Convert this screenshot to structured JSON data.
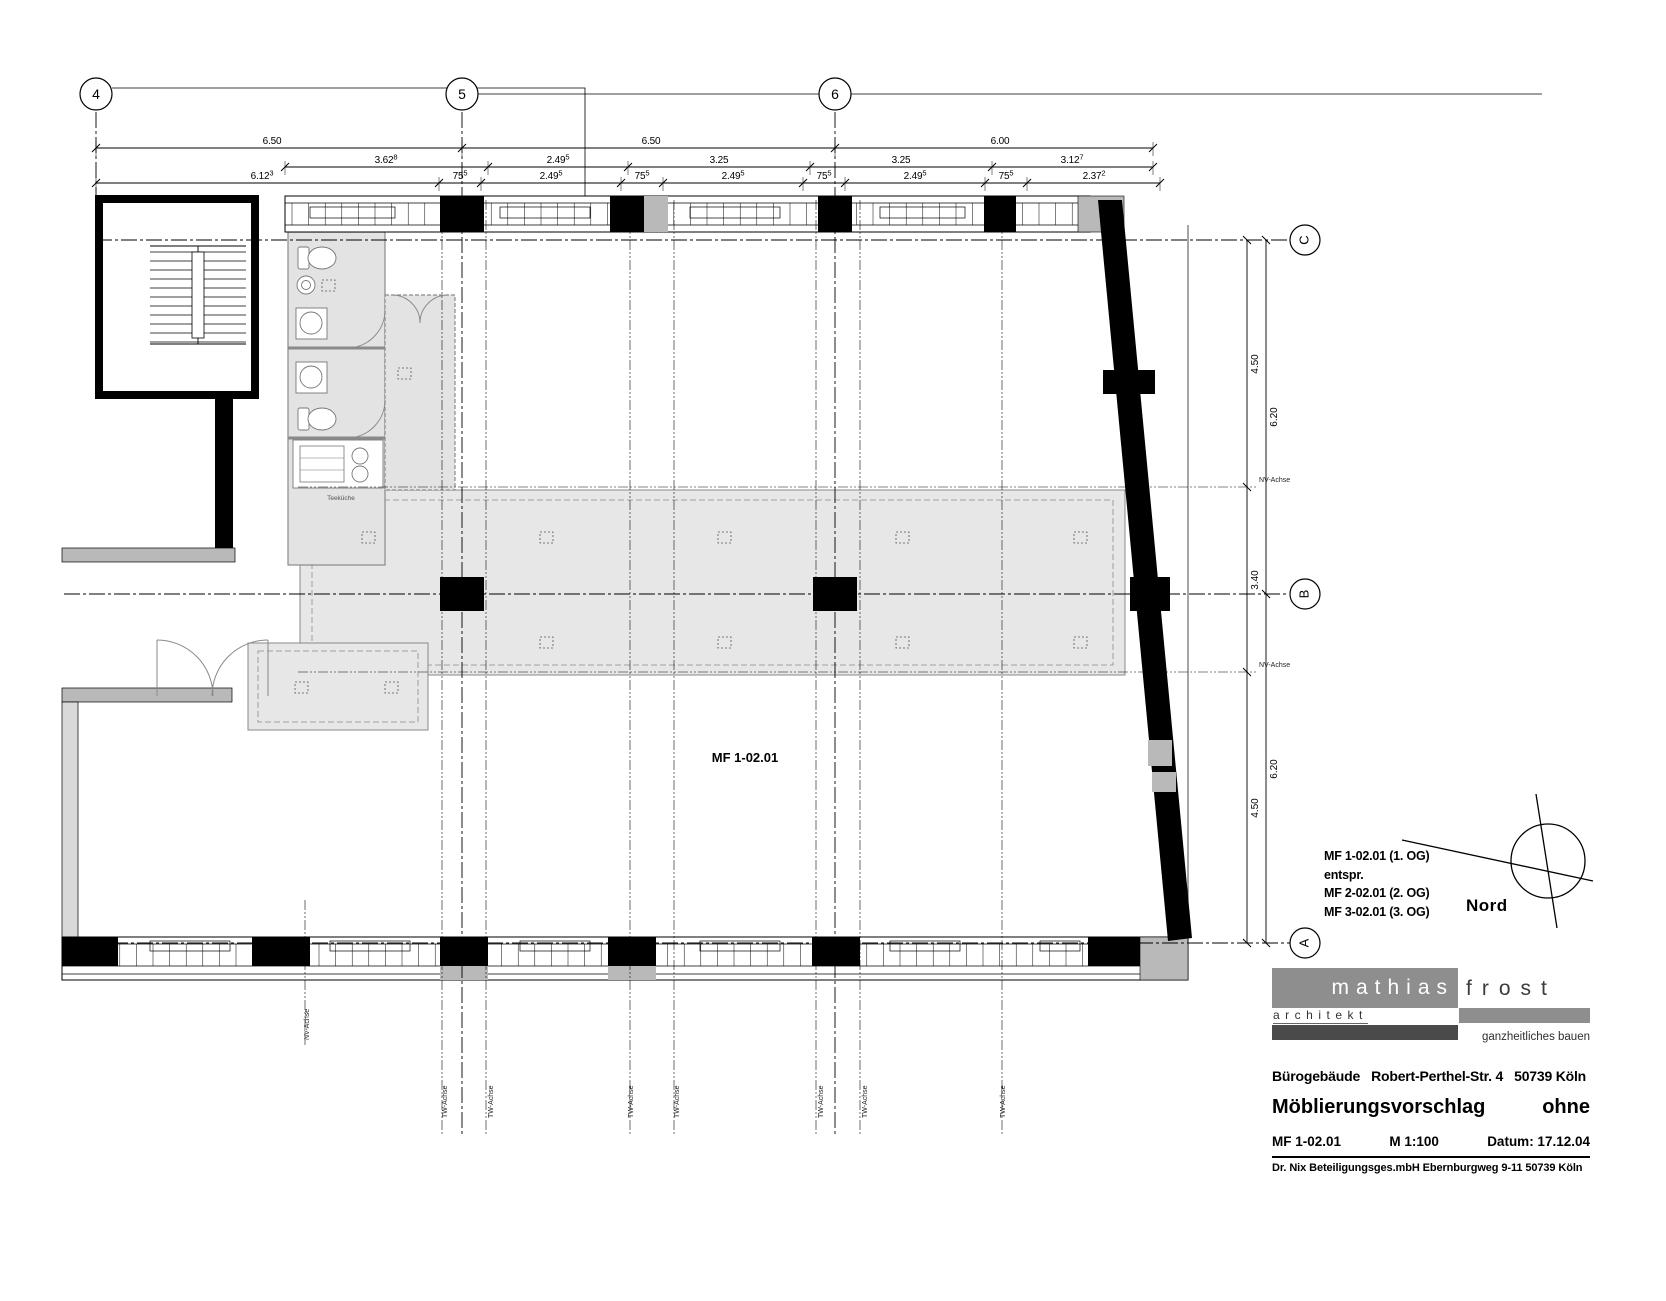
{
  "sheet_colors": {
    "ink": "#000000",
    "wall_gray": "#b9b9b9",
    "room_gray": "#e3e3e3",
    "zone_gray": "#e7e7e7",
    "logo_gray": "#8e8e8e",
    "dark_bar": "#4a4a4a"
  },
  "grid": {
    "top_y": 94,
    "top": [
      {
        "label": "4",
        "x": 96
      },
      {
        "label": "5",
        "x": 462
      },
      {
        "label": "6",
        "x": 835
      }
    ],
    "right_x": 1305,
    "right": [
      {
        "label": "C",
        "y": 240
      },
      {
        "label": "B",
        "y": 594
      },
      {
        "label": "A",
        "y": 943
      }
    ]
  },
  "dimensions": {
    "top_rows": [
      {
        "y": 148,
        "x1": 96,
        "x2": 1153,
        "ticks": [
          96,
          462,
          835,
          1153
        ],
        "labels": [
          {
            "t": "6.50",
            "x": 272
          },
          {
            "t": "6.50",
            "x": 651
          },
          {
            "t": "6.00",
            "x": 1000
          }
        ]
      },
      {
        "y": 167,
        "x1": 285,
        "x2": 1153,
        "ticks": [
          285,
          488,
          628,
          810,
          992,
          1153
        ],
        "labels": [
          {
            "t": "3.62",
            "s": "8",
            "x": 386
          },
          {
            "t": "2.49",
            "s": "5",
            "x": 558
          },
          {
            "t": "3.25",
            "x": 719
          },
          {
            "t": "3.25",
            "x": 901
          },
          {
            "t": "3.12",
            "s": "7",
            "x": 1072
          }
        ]
      },
      {
        "y": 183,
        "x1": 96,
        "x2": 1160,
        "ticks": [
          96,
          439,
          481,
          621,
          663,
          803,
          845,
          985,
          1027,
          1160
        ],
        "labels": [
          {
            "t": "6.12",
            "s": "3",
            "x": 262
          },
          {
            "t": "75",
            "s": "5",
            "x": 460
          },
          {
            "t": "2.49",
            "s": "5",
            "x": 551
          },
          {
            "t": "75",
            "s": "5",
            "x": 642
          },
          {
            "t": "2.49",
            "s": "5",
            "x": 733
          },
          {
            "t": "75",
            "s": "5",
            "x": 824
          },
          {
            "t": "2.49",
            "s": "5",
            "x": 915
          },
          {
            "t": "75",
            "s": "5",
            "x": 1006
          },
          {
            "t": "2.37",
            "s": "2",
            "x": 1094
          }
        ]
      }
    ],
    "right_chains": [
      {
        "x": 1247,
        "y1": 240,
        "y2": 943,
        "ticks": [
          240,
          487,
          672,
          943
        ],
        "labels": [
          {
            "t": "4.50",
            "y": 364
          },
          {
            "t": "3.40",
            "y": 580
          },
          {
            "t": "4.50",
            "y": 808
          }
        ]
      },
      {
        "x": 1266,
        "y1": 240,
        "y2": 943,
        "ticks": [
          240,
          594,
          943
        ],
        "labels": [
          {
            "t": "6.20",
            "y": 417
          },
          {
            "t": "6.20",
            "y": 769
          }
        ]
      }
    ]
  },
  "axis_small_labels": [
    {
      "text": "NV-Achse",
      "x": 1259,
      "y": 482,
      "rot": 0
    },
    {
      "text": "NV-Achse",
      "x": 1259,
      "y": 667,
      "rot": 0
    },
    {
      "text": "NV-Achse",
      "x": 309,
      "y": 1040,
      "rot": -90
    },
    {
      "text": "TW-Achse",
      "x": 447,
      "y": 1118,
      "rot": -90
    },
    {
      "text": "TW-Achse",
      "x": 493,
      "y": 1118,
      "rot": -90
    },
    {
      "text": "TW-Achse",
      "x": 633,
      "y": 1118,
      "rot": -90
    },
    {
      "text": "TW-Achse",
      "x": 679,
      "y": 1118,
      "rot": -90
    },
    {
      "text": "TW-Achse",
      "x": 823,
      "y": 1118,
      "rot": -90
    },
    {
      "text": "TW-Achse",
      "x": 867,
      "y": 1118,
      "rot": -90
    },
    {
      "text": "TW-Achse",
      "x": 1005,
      "y": 1118,
      "rot": -90
    }
  ],
  "room_label": {
    "text": "MF 1-02.01",
    "x": 745,
    "y": 762
  },
  "kitchen_label": {
    "text": "Teeküche",
    "x": 341,
    "y": 500
  },
  "north_label": "Nord",
  "legend": {
    "lines": [
      "MF 1-02.01 (1. OG)",
      "entspr.",
      "MF 2-02.01 (2. OG)",
      "MF 3-02.01 (3. OG)"
    ]
  },
  "logo": {
    "name_left": "mathias",
    "name_right": "frost",
    "profession": "architekt",
    "tagline": "ganzheitliches bauen"
  },
  "title_block": {
    "project": "Bürogebäude   Robert-Perthel-Str. 4   50739 Köln",
    "subject": "Möblierungsvorschlag",
    "subject_right": "ohne",
    "drawing_no": "MF 1-02.01",
    "scale": "M 1:100",
    "date": "Datum: 17.12.04",
    "client": "Dr. Nix Beteiligungsges.mbH Ebernburgweg 9-11  50739 Köln"
  }
}
